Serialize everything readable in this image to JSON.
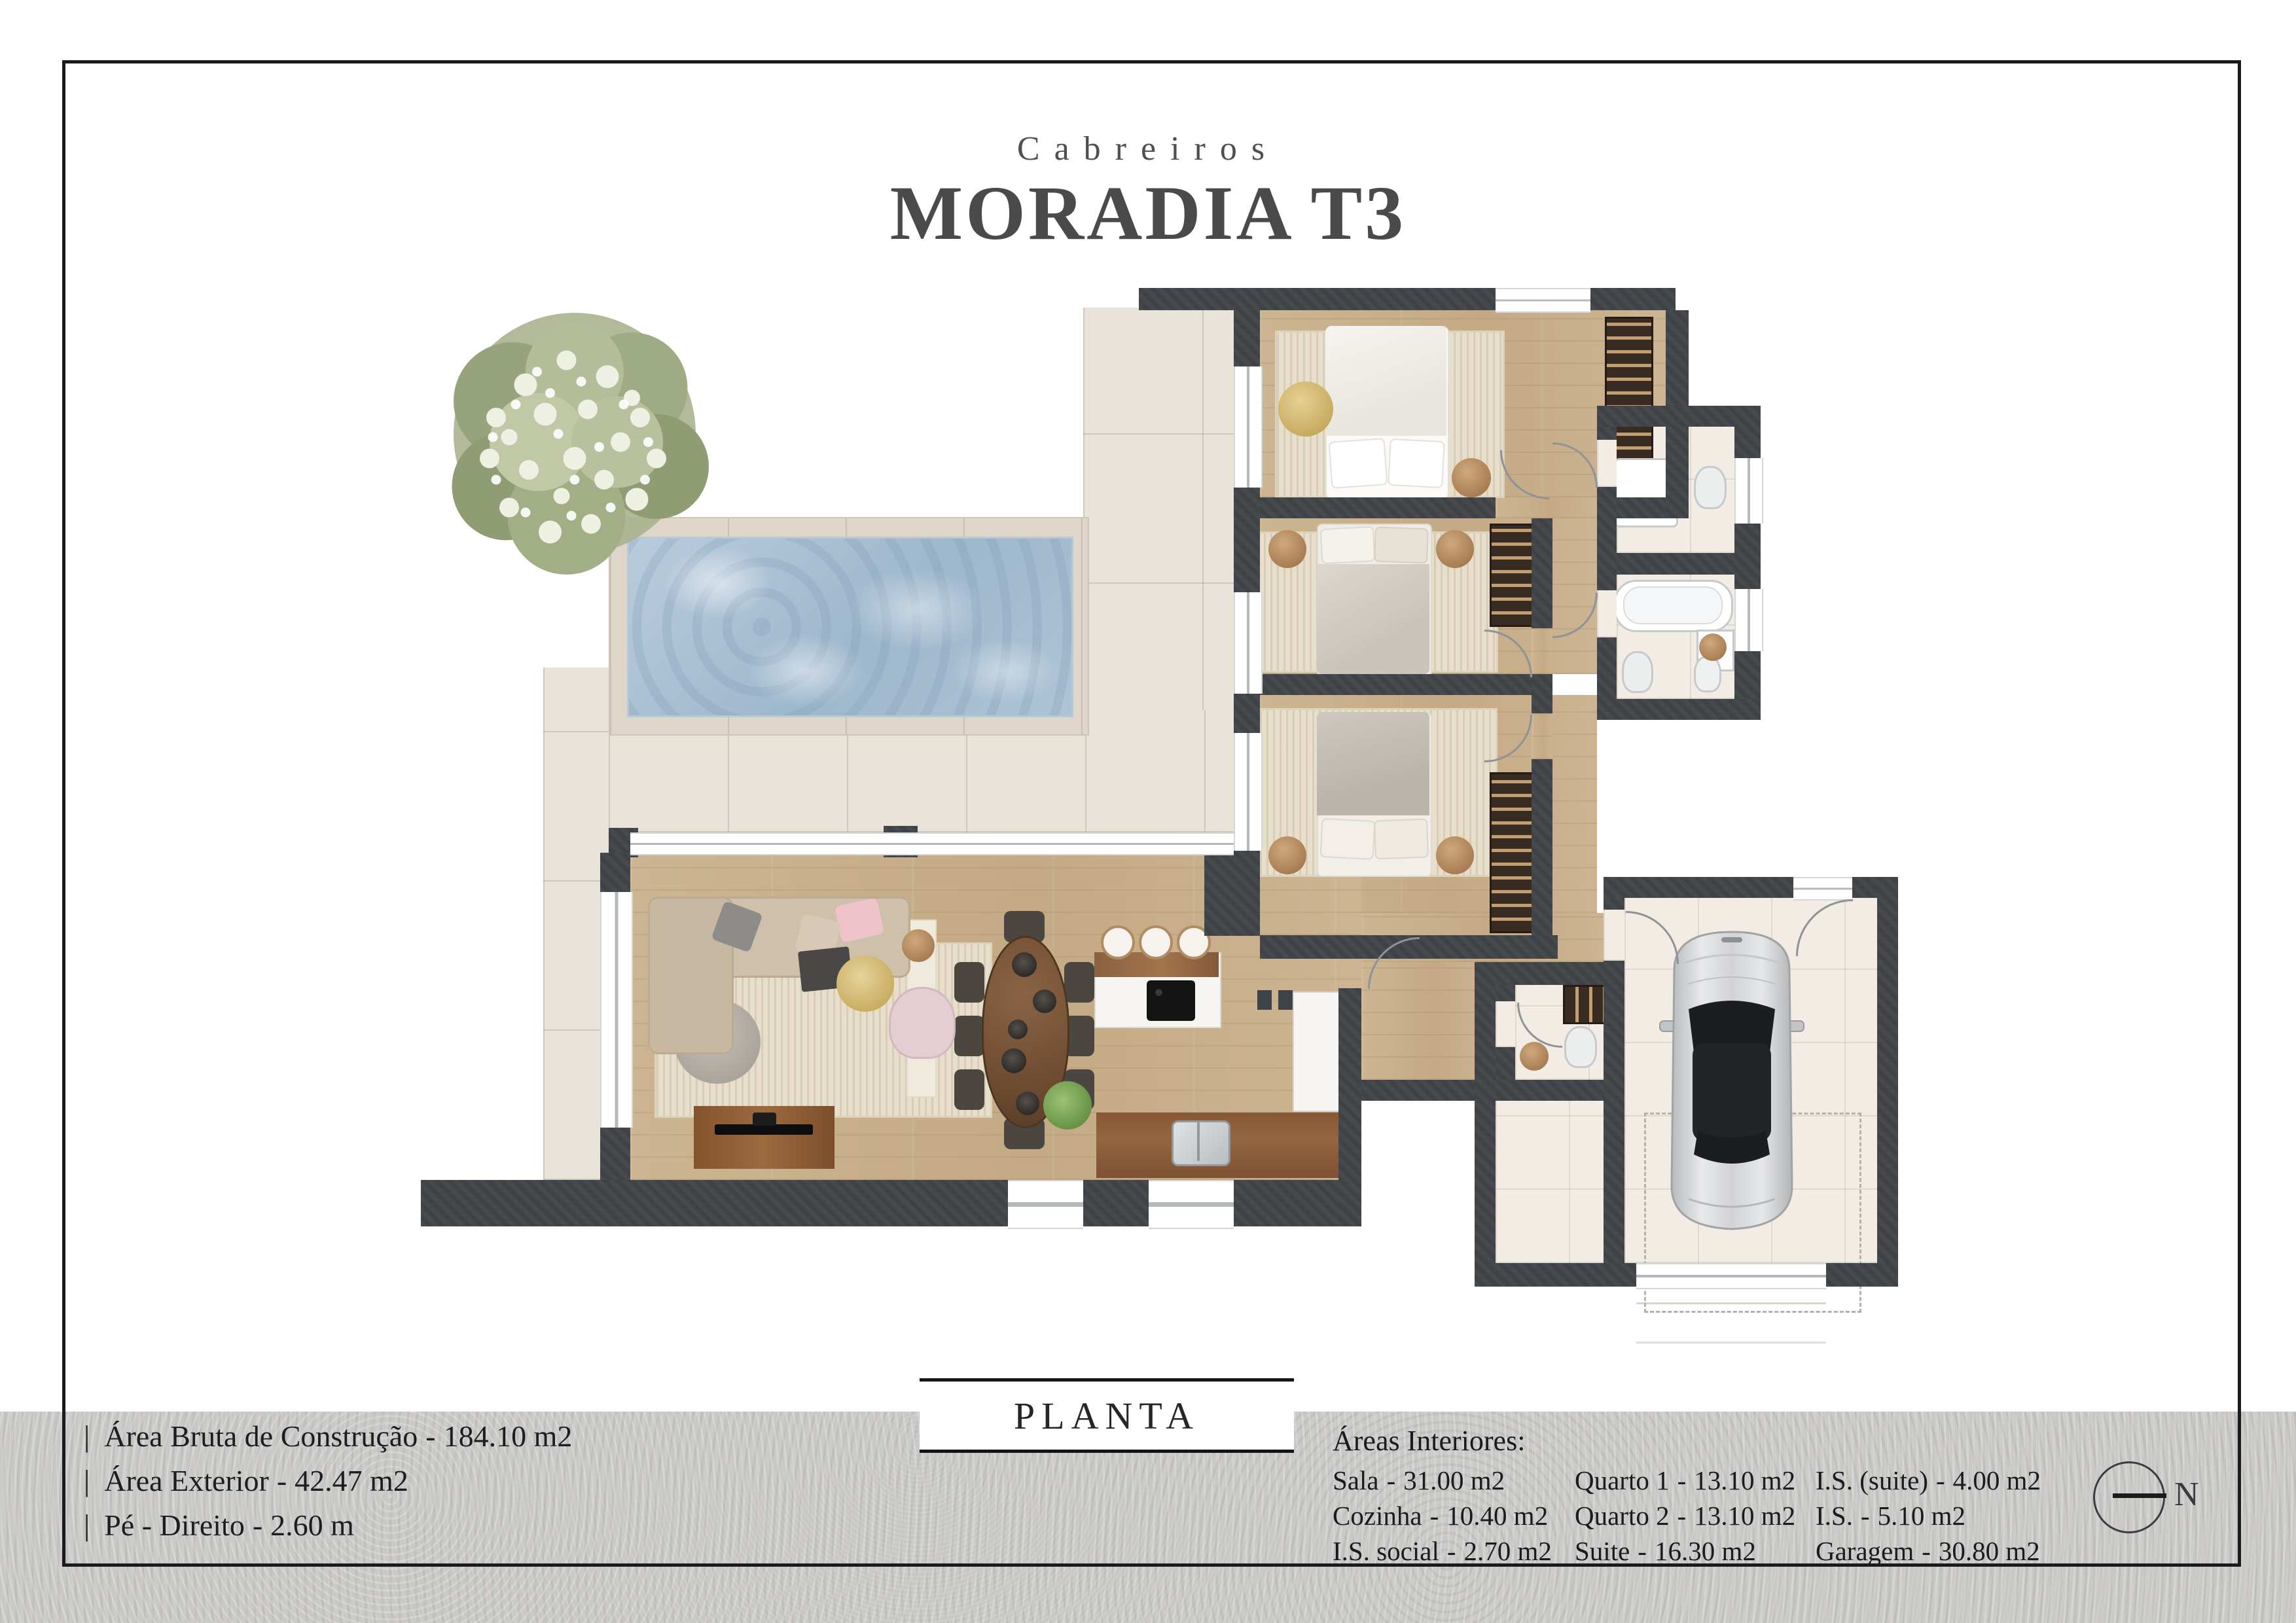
{
  "header": {
    "brand": "Cabreiros",
    "title": "MORADIA T3"
  },
  "plan": {
    "label": "PLANTA"
  },
  "ui": {
    "pipe": "|",
    "sep": "-",
    "north": "N"
  },
  "specs": [
    {
      "label": "Área Bruta de Construção",
      "value": "184.10 m2"
    },
    {
      "label": "Área Exterior",
      "value": "42.47 m2"
    },
    {
      "label": "Pé - Direito",
      "value": "2.60 m"
    }
  ],
  "areas": {
    "heading": "Áreas Interiores:",
    "columns": [
      [
        {
          "name": "Sala",
          "area": "31.00 m2"
        },
        {
          "name": "Cozinha",
          "area": "10.40 m2"
        },
        {
          "name": "I.S. social",
          "area": "2.70 m2"
        }
      ],
      [
        {
          "name": "Quarto 1",
          "area": "13.10 m2"
        },
        {
          "name": "Quarto 2",
          "area": "13.10 m2"
        },
        {
          "name": "Suite",
          "area": "16.30 m2"
        }
      ],
      [
        {
          "name": "I.S. (suite)",
          "area": "4.00 m2"
        },
        {
          "name": "I.S.",
          "area": "5.10 m2"
        },
        {
          "name": "Garagem",
          "area": "30.80 m2"
        }
      ]
    ]
  },
  "colors": {
    "wall": "#3f4347",
    "wood_floor": "#c9b18e",
    "patio_tile": "#e9e3da",
    "bath_tile": "#f2ece4",
    "pool_water": "#a9c1d6",
    "band_gray": "#c9c8c6",
    "frame": "#1b1b1b",
    "title_text": "#4a4a4a",
    "body_text": "#1d1d1d"
  }
}
